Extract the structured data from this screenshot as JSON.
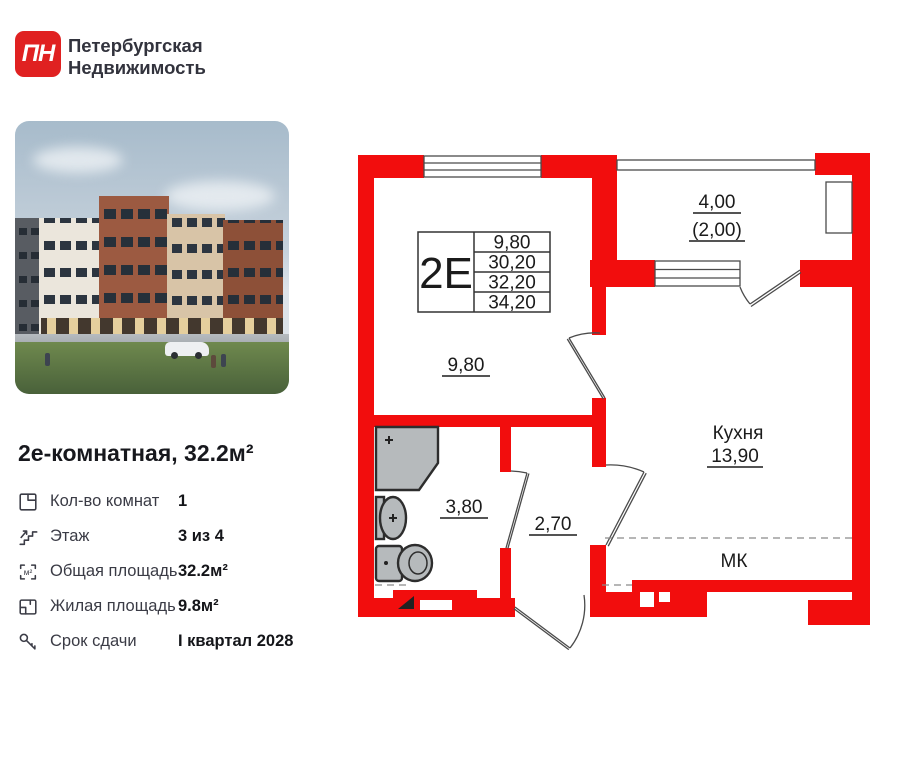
{
  "colors": {
    "wall": "#f20d0d",
    "accent": "#e02121"
  },
  "brand": {
    "logo": "ПН",
    "line1": "Петербургская",
    "line2": "Недвижимость"
  },
  "listing": {
    "title": "2е-комнатная, 32.2м²"
  },
  "icons": {
    "m2": "м²"
  },
  "details": [
    {
      "icon": "rooms-icon",
      "label": "Кол-во комнат",
      "value": "1"
    },
    {
      "icon": "floor-icon",
      "label": "Этаж",
      "value": "3 из 4"
    },
    {
      "icon": "total-area-icon",
      "label": "Общая площадь",
      "value": "32.2м²"
    },
    {
      "icon": "living-area-icon",
      "label": "Жилая площадь",
      "value": "9.8м²"
    },
    {
      "icon": "deadline-icon",
      "label": "Срок сдачи",
      "value": "I квартал 2028"
    }
  ],
  "floor_plan": {
    "unit": "2Е",
    "table_rows": [
      "9,80",
      "30,20",
      "32,20",
      "34,20"
    ],
    "labels": {
      "room_area": "9,80",
      "balcony_area": "4,00",
      "balcony_reduced": "(2,00)",
      "kitchen_name": "Кухня",
      "kitchen_area": "13,90",
      "bathroom_area": "3,80",
      "hallway_area": "2,70",
      "mk": "МК"
    }
  }
}
